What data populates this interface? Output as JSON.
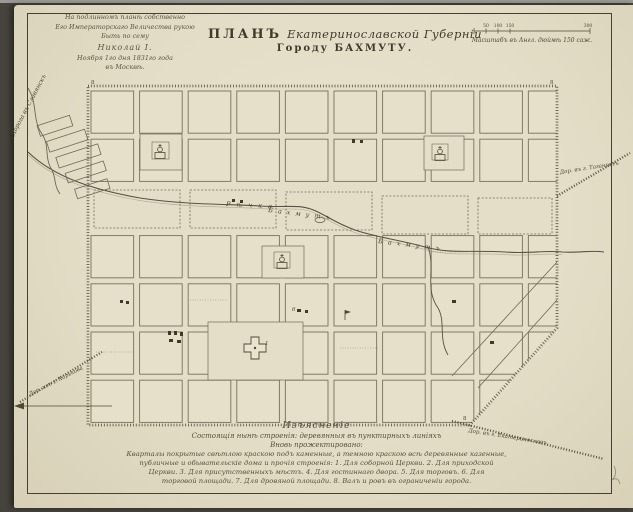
{
  "palette": {
    "paper": "#e3ddc7",
    "backdrop": "#45433c",
    "ink": "#4f4836",
    "map_line": "#6f6857",
    "rampart": "#5a5340"
  },
  "inscription": {
    "lines": [
      "На подлинномъ планѣ собственно",
      "Его Императорскаго Величества рукою",
      "Быть по сему",
      "Николай I.",
      "Ноября 1го дня 1831го года",
      "въ Москвѣ."
    ]
  },
  "title": {
    "plan_word": "ПЛАНЪ",
    "province_script": "Екатеринославской Губерніи",
    "city_line": "Городу БАХМУТУ."
  },
  "scale_bar": {
    "tick_labels": [
      "50",
      "100",
      "150",
      "300"
    ],
    "caption": "Масштабъ въ Англ. дюймѣ 150 саж."
  },
  "map": {
    "river_name_first": "Рѣчка",
    "river_name_second": "Бахмутъ",
    "rampart_mark": "8",
    "block_number_1": "1",
    "block_number_6": "6",
    "roads": {
      "northwest": "Дорога въ Славянскъ",
      "east": "Дор. въ г. Таганрогъ",
      "southwest": "Дор. изъ г. Харькова",
      "southeast": "Дор. въ г. Екатеринославъ"
    }
  },
  "legend": {
    "header": "Изъясненіе",
    "existing_line": "Состоящія нынѣ строенія: деревянныя въ пунктирныхъ линіяхъ",
    "projected_line": "Вновь прожектировано:",
    "body_lines": [
      "Кварталы покрытые свѣтлою краскою подъ каменные, а темною краскою всѣ деревянные казенные,",
      "публичные и обывательскіе дома и прочія строенія: 1. Для соборной Церкви. 2. Для приходской",
      "Церкви. 3. Для присутственныхъ мѣстъ. 4. Для гостиннаго двора. 5. Для торговъ. 6. Для",
      "торговой площади. 7. Для дровяной площади. 8. Валъ и ровъ въ ограниченіи города."
    ]
  }
}
